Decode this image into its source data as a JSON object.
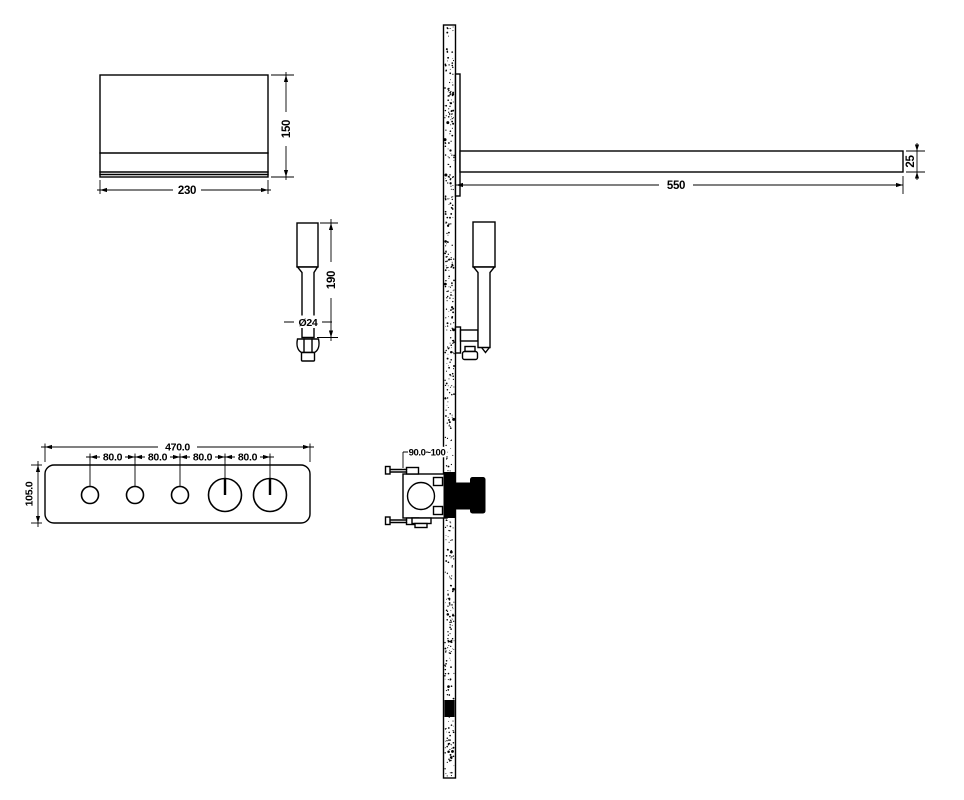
{
  "drawing": {
    "background_color": "#ffffff",
    "line_color": "#000000",
    "views": {
      "head_shower_front": {
        "width_label": "230",
        "height_label": "150"
      },
      "shower_arm_side": {
        "length_label": "550",
        "thickness_label": "25"
      },
      "hand_shower_front": {
        "height_label": "190",
        "diameter_label": "Ø24"
      },
      "control_panel_front": {
        "width_label": "470.0",
        "height_label": "105.0",
        "spacing_labels": [
          "80.0",
          "80.0",
          "80.0",
          "80.0"
        ],
        "knobs": [
          "small",
          "small",
          "small",
          "large",
          "large"
        ]
      },
      "valve_side": {
        "embed_depth_label": "90.0~100"
      }
    }
  }
}
